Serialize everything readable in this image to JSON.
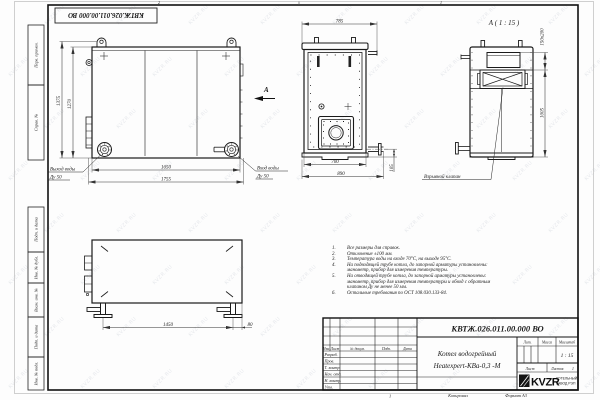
{
  "watermark": "KVZR.RU",
  "frame": {
    "stamp_rotated": "КВТЖ.026.011.00.000 ВО",
    "zone_top_left": "2",
    "zone_top_right": "1",
    "zone_bottom": "1",
    "margin_labels": [
      "Перв. примен.",
      "Справ. №",
      "Подп. и дата",
      "Инв. № дубл.",
      "Взам. инв. №",
      "Подп. и дата",
      "Инв. № подл."
    ]
  },
  "views": {
    "side": {
      "dim_height_outer": "1375",
      "dim_height_inner": "1270",
      "dim_width_inner": "1650",
      "dim_width_outer": "1755",
      "outlet_label": "Выход воды",
      "outlet_dn": "Ду 50",
      "inlet_label": "Вход воды",
      "inlet_dn": "Ду 50",
      "section_mark": "А"
    },
    "front": {
      "dim_width_top": "785",
      "dim_width_inner": "700",
      "dim_width_outer": "890",
      "dim_pipe": "105"
    },
    "detail": {
      "title": "А ( 1 : 15 )",
      "dim_valve": "150x200",
      "dim_height": "1005",
      "callout": "Взрывной клапан"
    },
    "top": {
      "dim_length": "1450",
      "dim_offset": "80"
    }
  },
  "notes": [
    {
      "num": "1.",
      "text": "Все размеры для справок."
    },
    {
      "num": "2.",
      "text": "Отклонение ±100 мм."
    },
    {
      "num": "3.",
      "text": "Температура воды на входе 70°С, на выходе 95°С."
    },
    {
      "num": "4.",
      "text": "На подводящей трубе котла, до запорной арматуры установлены:"
    },
    {
      "num": "",
      "text": "манометр, прибор для измерения температуры."
    },
    {
      "num": "5.",
      "text": "На отводящей трубе котла, до запорной арматуры установлены:"
    },
    {
      "num": "",
      "text": "манометр, прибор для измерения температуры и обвод с обратным"
    },
    {
      "num": "",
      "text": "клапаном Ду не менее 50 мм."
    },
    {
      "num": "6.",
      "text": "Остальные требования по ОСТ 108.030.133-84."
    }
  ],
  "title_block": {
    "doc_number": "КВТЖ.026.011.00.000 ВО",
    "product_line1": "Котел водогрейный",
    "product_line2": "Heatexpert-КВа-0,3 -М",
    "col_izm": "Изм.",
    "col_list": "Лист",
    "col_doc": "№ докум.",
    "col_podp": "Подп.",
    "col_data": "Дата",
    "rows": [
      "Разраб.",
      "Пров.",
      "Т. контр.",
      "Нач. отд.",
      "Н. контр.",
      "Утв."
    ],
    "lit": "Лит.",
    "massa": "Масса",
    "masshtab": "Масштаб",
    "scale": "1 : 15",
    "list_label": "Лист",
    "listov_label": "Листов",
    "listov_value": "1",
    "logo": "KVZR",
    "logo_line1": "КОТЕЛЬНЫЙ",
    "logo_line2": "ЗАВОД РЭП",
    "copied": "Копировал",
    "format": "Формат А3"
  }
}
